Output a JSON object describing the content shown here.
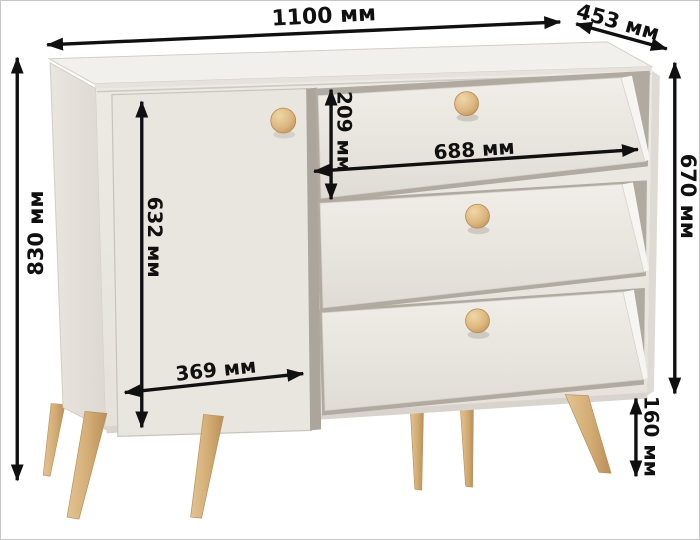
{
  "diagram": {
    "subject": "chest of drawers with one door, three drawers, wooden knobs and six tapered wooden legs",
    "dimensions": {
      "overall_width": "1100 мм",
      "depth": "453 мм",
      "overall_height": "830 мм",
      "body_height": "670 мм",
      "top_drawer_height": "209 мм",
      "drawer_width": "688 мм",
      "door_height": "632 мм",
      "door_width": "369 мм",
      "leg_height": "160 мм"
    },
    "colors": {
      "dimension_lines": "#101010",
      "body_front": "#eae6e0",
      "top_surface": "#f2f0ec",
      "side_panel": "#e4e0d9",
      "shadow_gap": "#aba59c",
      "wood_knob": "#dcb67e",
      "wood_leg": "#d3ac74",
      "background": "#ffffff"
    }
  }
}
